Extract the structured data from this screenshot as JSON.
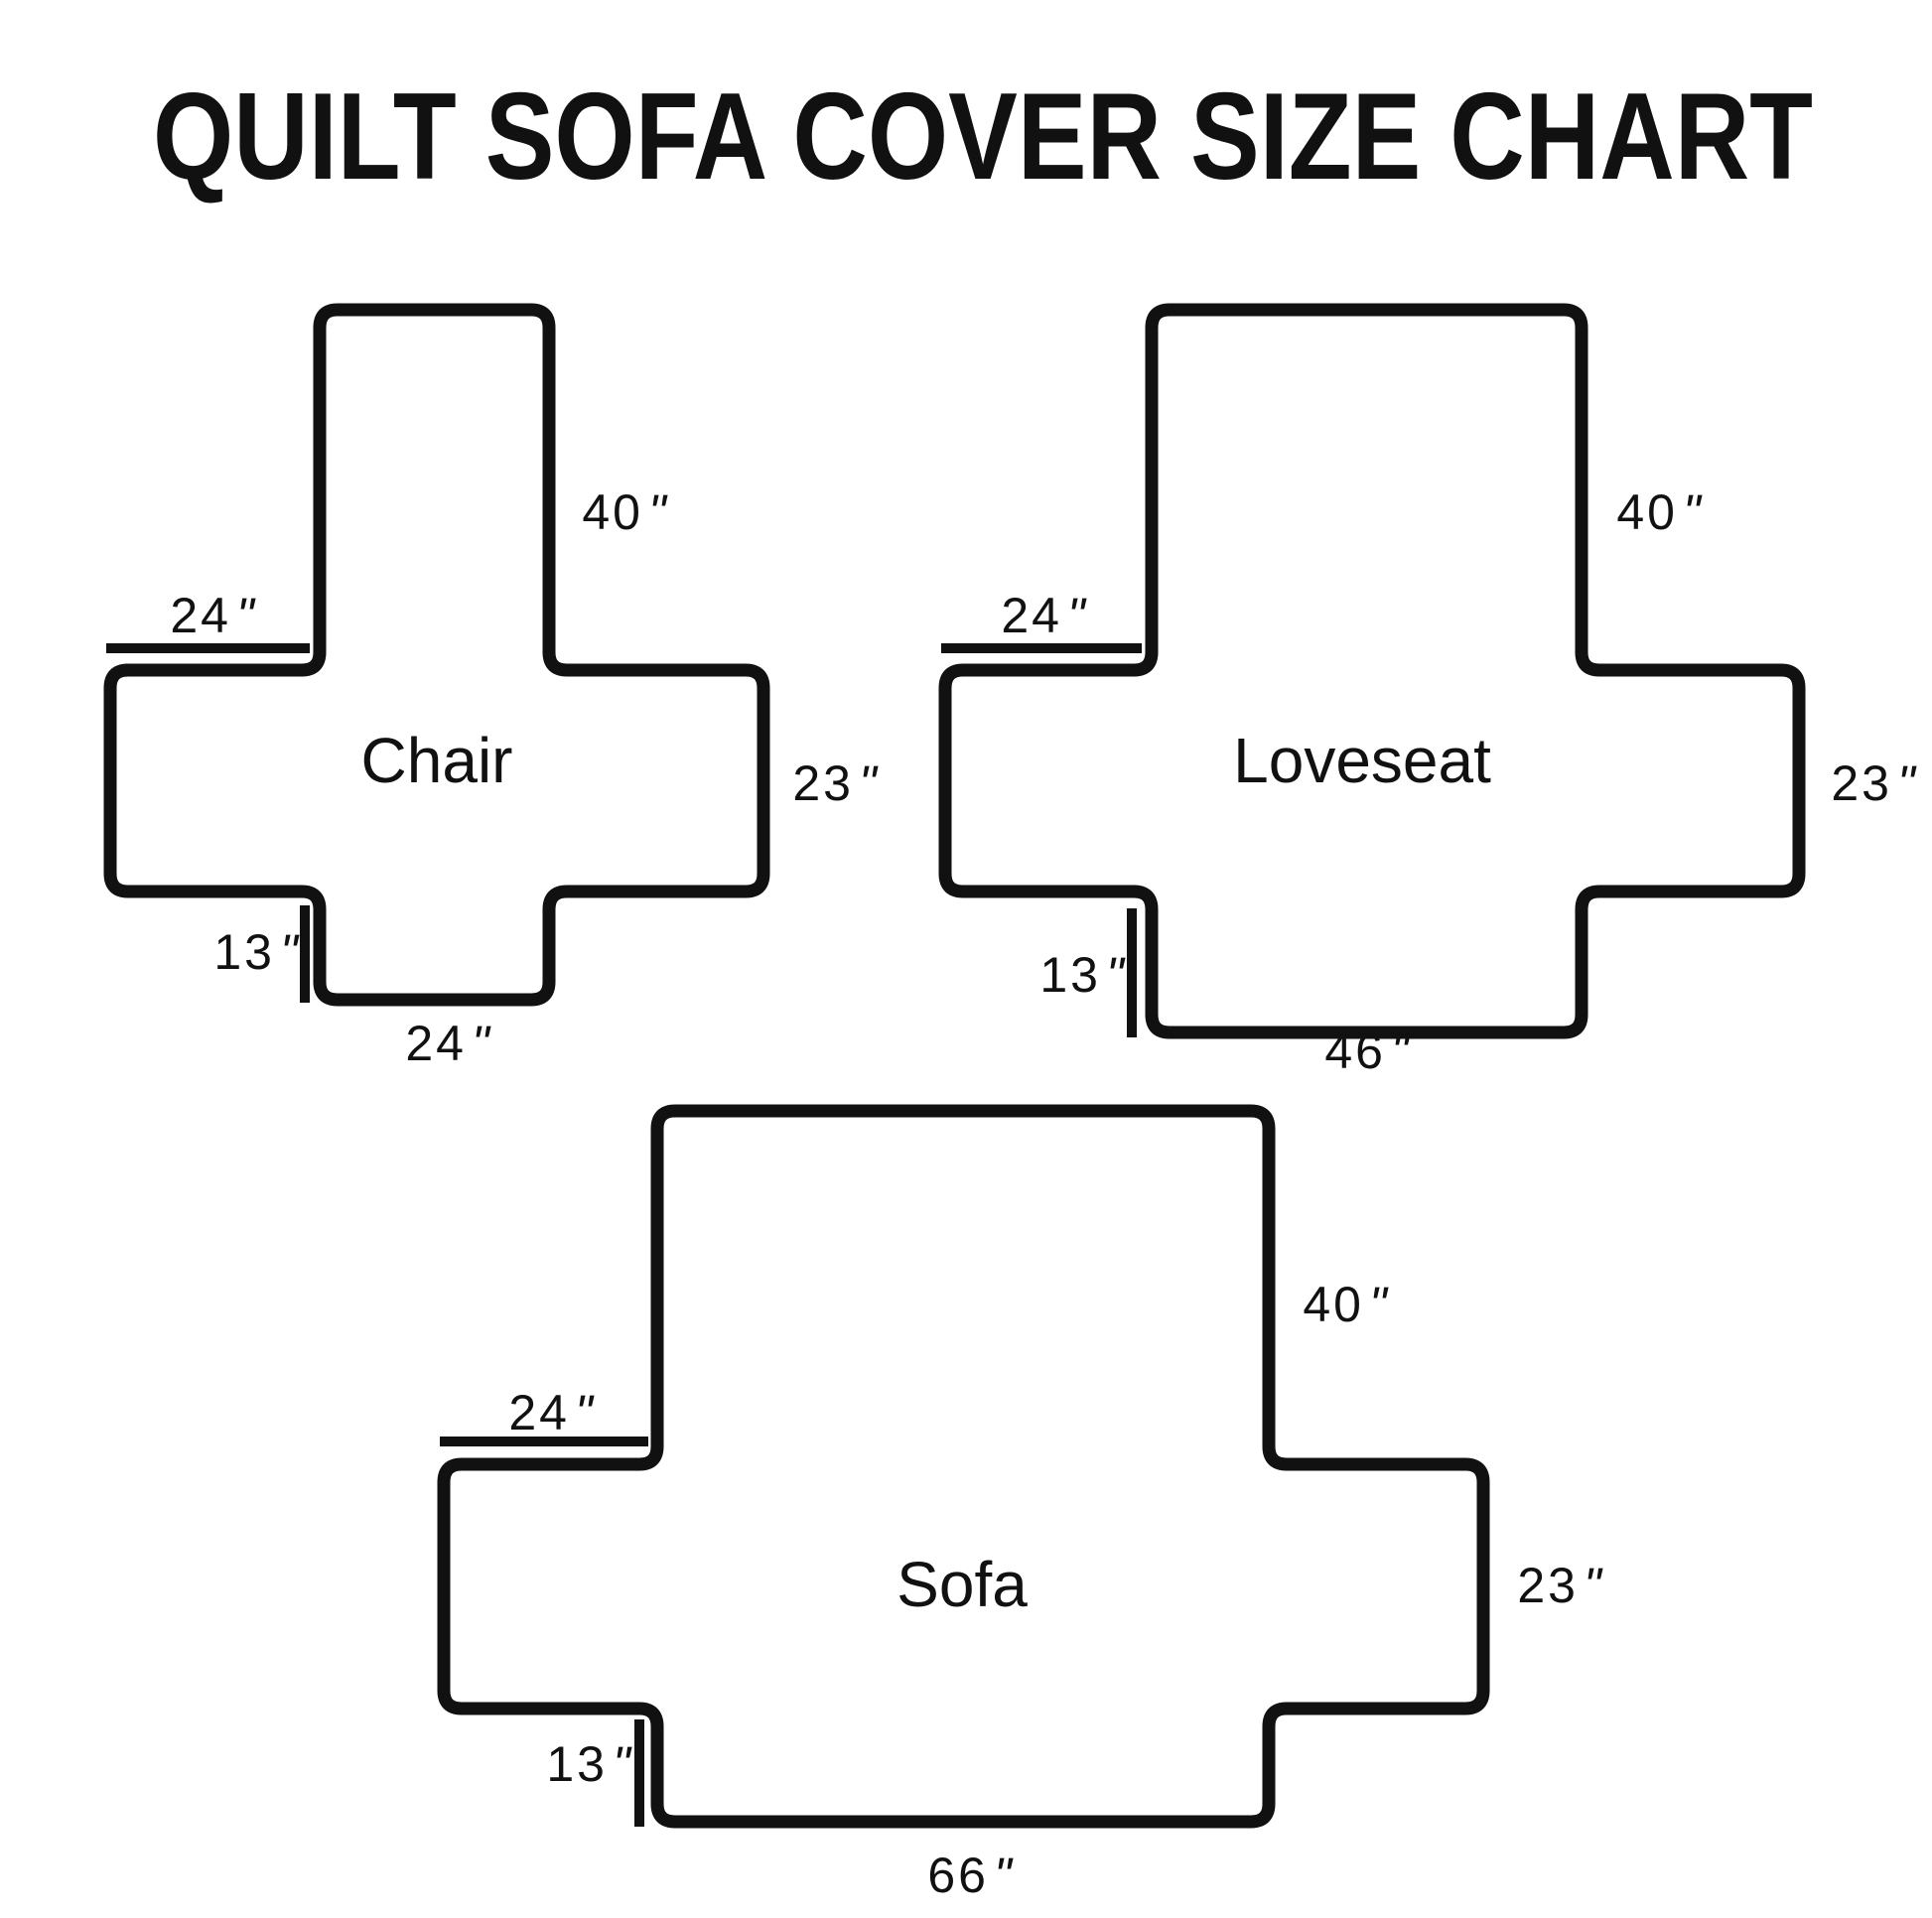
{
  "title": "QUILT SOFA COVER SIZE CHART",
  "unit_mark": "\"",
  "colors": {
    "ink": "#111111",
    "background": "#ffffff"
  },
  "diagrams": [
    {
      "id": "chair",
      "name": "Chair",
      "dims": {
        "back_height": "40",
        "arm_length": "24",
        "side_drop": "23",
        "front_drop": "13",
        "seat_width": "24"
      }
    },
    {
      "id": "loveseat",
      "name": "Loveseat",
      "dims": {
        "back_height": "40",
        "arm_length": "24",
        "side_drop": "23",
        "front_drop": "13",
        "seat_width": "46"
      }
    },
    {
      "id": "sofa",
      "name": "Sofa",
      "dims": {
        "back_height": "40",
        "arm_length": "24",
        "side_drop": "23",
        "front_drop": "13",
        "seat_width": "66"
      }
    }
  ]
}
